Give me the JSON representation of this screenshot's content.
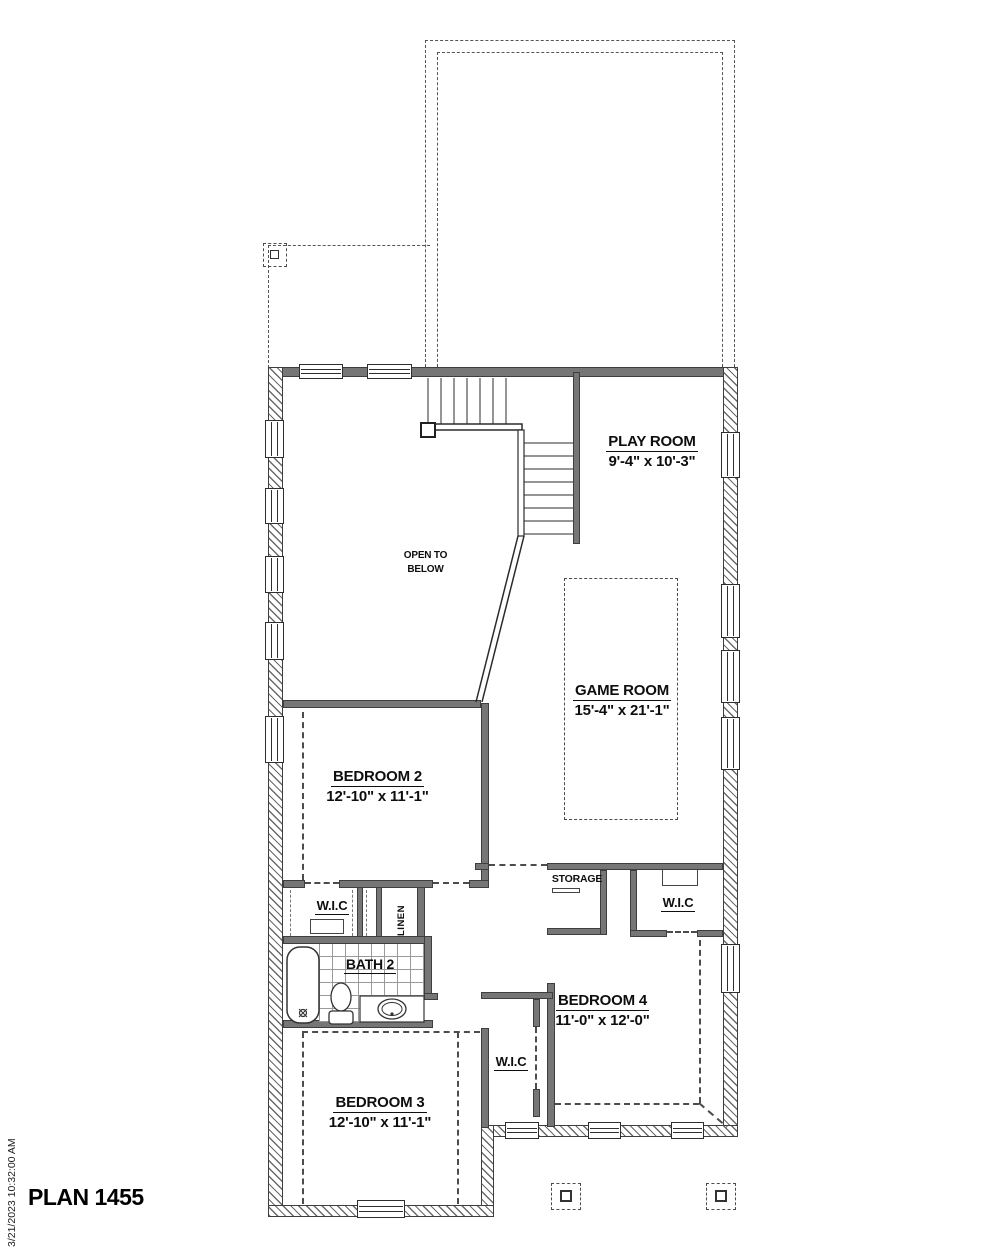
{
  "meta": {
    "plan_title": "PLAN 1455",
    "print_timestamp": "3/21/2023 10:32:00 AM"
  },
  "rooms": {
    "play_room": {
      "name": "PLAY ROOM",
      "dims": "9'-4\" x 10'-3\""
    },
    "game_room": {
      "name": "GAME ROOM",
      "dims": "15'-4\" x 21'-1\""
    },
    "bedroom_2": {
      "name": "BEDROOM 2",
      "dims": "12'-10\" x 11'-1\""
    },
    "bedroom_3": {
      "name": "BEDROOM 3",
      "dims": "12'-10\" x 11'-1\""
    },
    "bedroom_4": {
      "name": "BEDROOM 4",
      "dims": "11'-0\" x 12'-0\""
    },
    "bath_2": {
      "name": "BATH 2"
    },
    "open_to_below": {
      "line1": "OPEN TO",
      "line2": "BELOW"
    }
  },
  "closets": {
    "wic_bedroom_2": "W.I.C",
    "wic_bedroom_4": "W.I.C",
    "wic_hall": "W.I.C",
    "linen": "LINEN",
    "storage": "STORAGE"
  },
  "colors": {
    "wall": "#767676",
    "line": "#2b2b2b",
    "dash": "#4c4c4c"
  }
}
